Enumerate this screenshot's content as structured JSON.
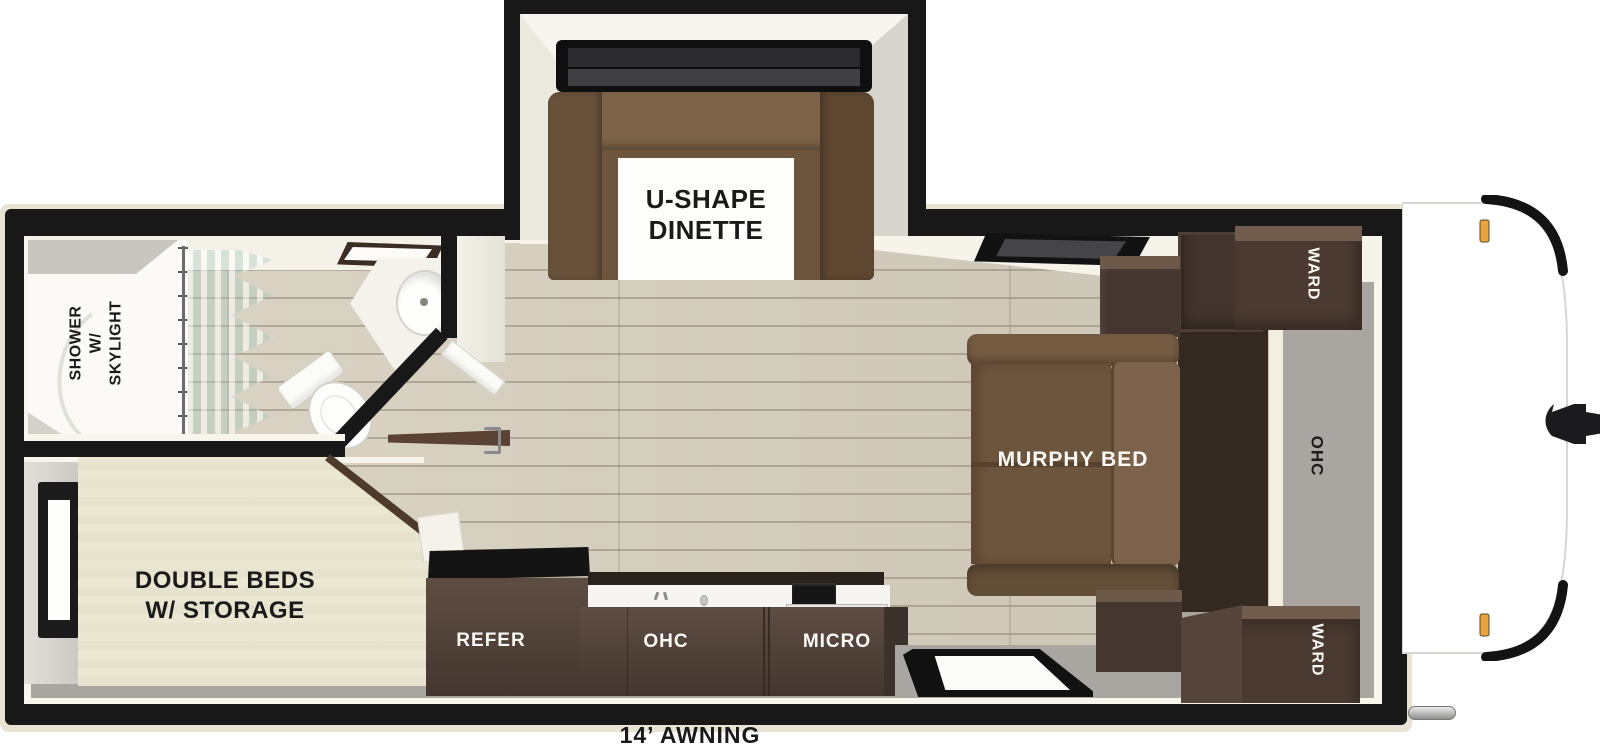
{
  "title": "Travel trailer floor plan",
  "labels": {
    "dinette": {
      "line1": "U-SHAPE",
      "line2": "DINETTE"
    },
    "shower": {
      "line1": "SHOWER",
      "line2": "W/ SKYLIGHT"
    },
    "double_beds": {
      "line1": "DOUBLE BEDS",
      "line2": "W/ STORAGE"
    },
    "murphy_bed": "MURPHY BED",
    "ward_top": "WARD",
    "ward_bottom": "WARD",
    "ohc_front": "OHC",
    "refer": "REFER",
    "ohc_kitchen": "OHC",
    "micro": "MICRO",
    "awning": "14’ AWNING"
  },
  "colors": {
    "wall": "#181818",
    "outer_trim": "#e8e3d3",
    "inner_lining": "#f7f5ec",
    "wood_floor": "#d8d1c0",
    "gray_floor": "#a9a6a1",
    "bed_platform": "#ebe6d2",
    "sofa_brown": "#6d543c",
    "cabinet_brown": "#4a3a31",
    "murphy_frame": "#342921",
    "shower_curtain": "#cfe8e0",
    "marker_light_orange": "#e9a43c",
    "front_cap": "#ffffff"
  }
}
